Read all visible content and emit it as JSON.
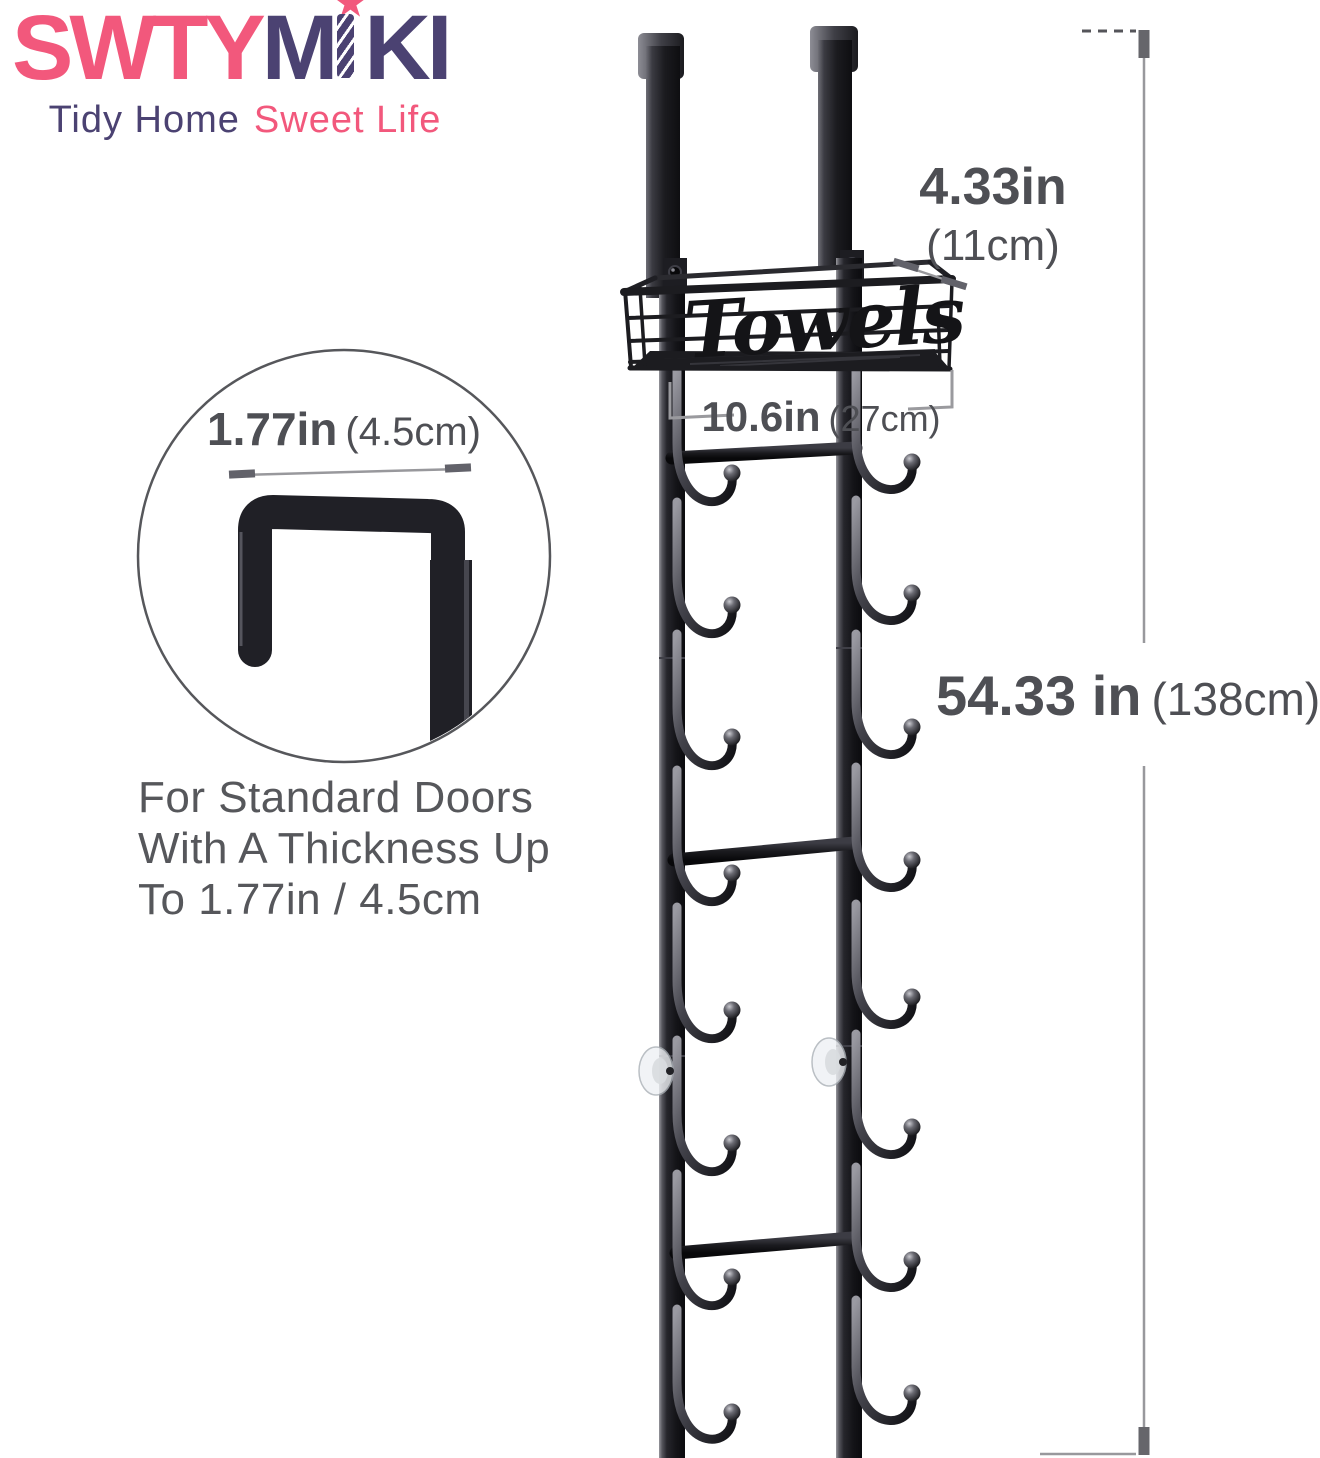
{
  "brand": {
    "logo_parts": [
      "SWTY",
      "M",
      "I",
      "KI"
    ],
    "star_icon": "★",
    "tagline_left": "Tidy Home",
    "tagline_right": "Sweet Life",
    "pink": "#F2587C",
    "purple": "#4B4272"
  },
  "product": {
    "basket_label": "Towels"
  },
  "annotations": {
    "hook_clearance": {
      "value": "1.77in",
      "metric": "(4.5cm)"
    },
    "basket_depth": {
      "value": "4.33in",
      "metric": "(11cm)"
    },
    "basket_width": {
      "value": "10.6in",
      "metric": "(27cm)"
    },
    "total_height": {
      "value": "54.33 in",
      "metric": "(138cm)"
    },
    "door_note": {
      "line1": "For Standard Doors",
      "line2": "With A Thickness Up",
      "line3": "To 1.77in / 4.5cm"
    },
    "text_color": "#4E4F54",
    "line_color": "#98989C"
  }
}
